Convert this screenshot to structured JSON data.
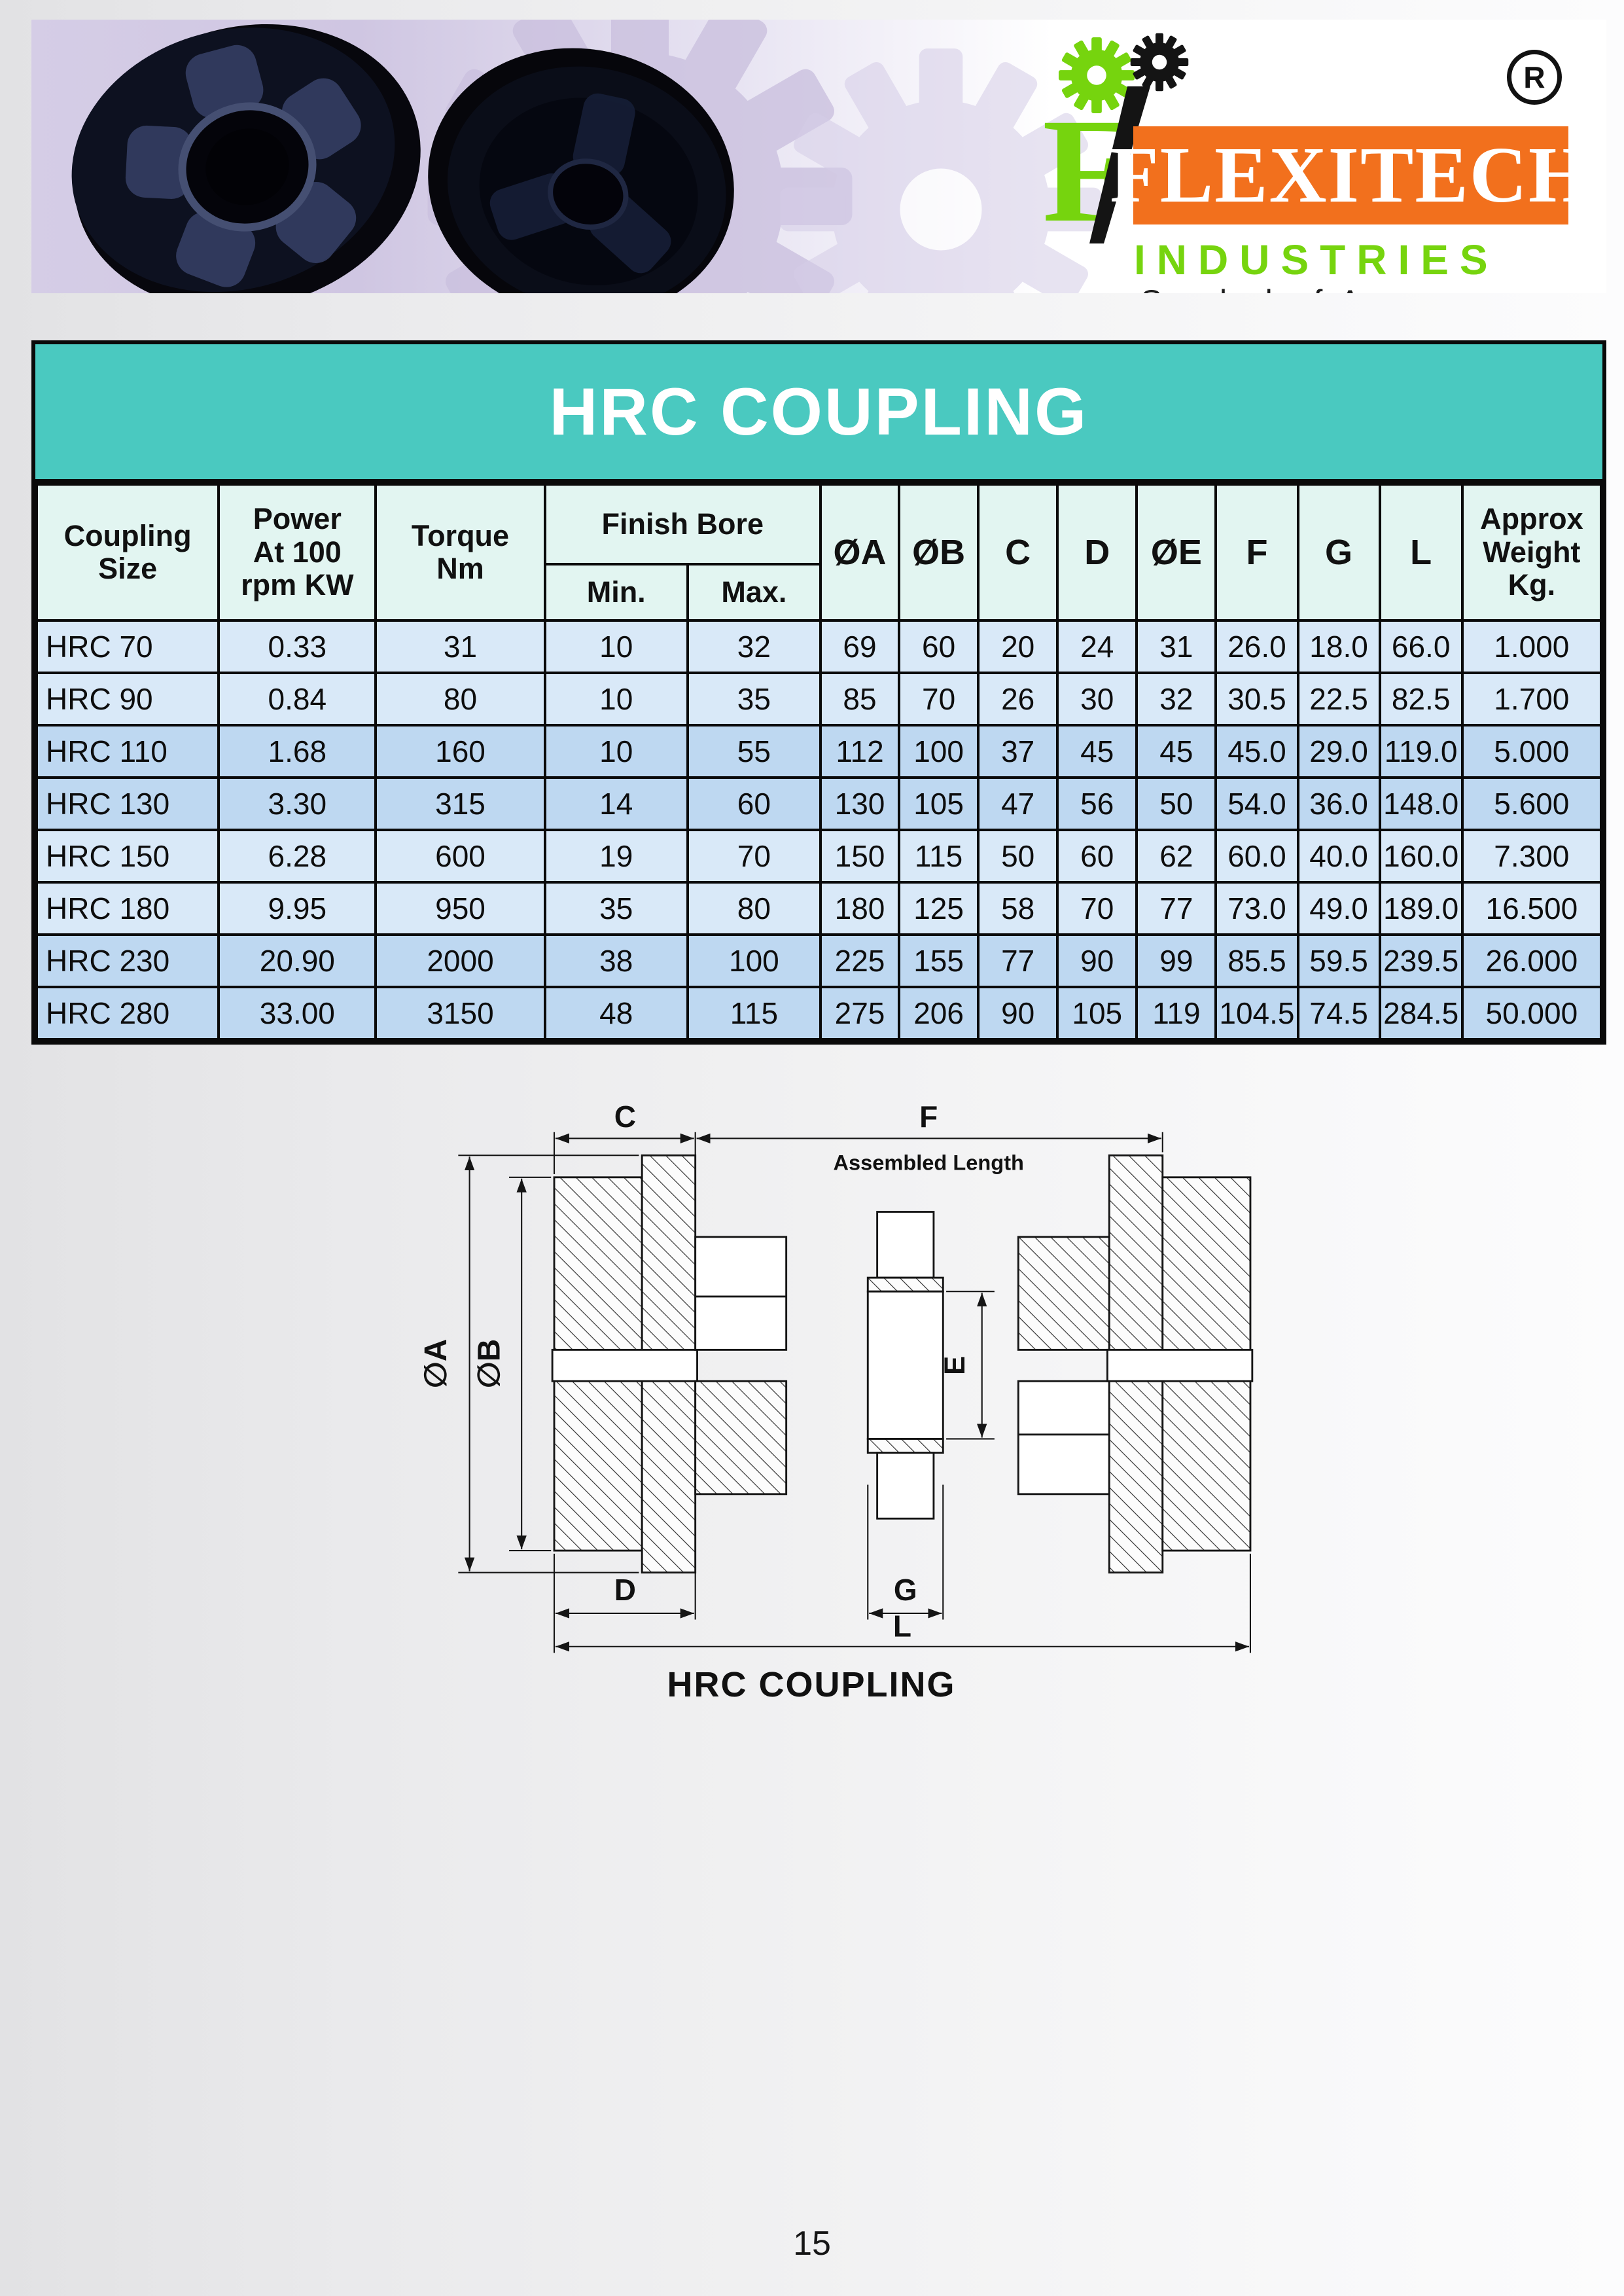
{
  "brand": {
    "name": "FLEXITECH",
    "division": "INDUSTRIES",
    "tagline": "Symbol of Accuracy",
    "registered": "R",
    "colors": {
      "orange": "#f2701d",
      "green": "#76d40e",
      "teal": "#4ac9c0"
    }
  },
  "title_banner": {
    "text": "HRC COUPLING"
  },
  "table": {
    "header": {
      "coupling_size": "Coupling\nSize",
      "power": "Power\nAt 100\nrpm KW",
      "torque": "Torque\nNm",
      "finish_bore": "Finish Bore",
      "min": "Min.",
      "max": "Max.",
      "dia_a": "ØA",
      "dia_b": "ØB",
      "c": "C",
      "d": "D",
      "dia_e": "ØE",
      "f": "F",
      "g": "G",
      "l": "L",
      "weight": "Approx\nWeight\nKg."
    },
    "rows": [
      [
        "HRC 70",
        "0.33",
        "31",
        "10",
        "32",
        "69",
        "60",
        "20",
        "24",
        "31",
        "26.0",
        "18.0",
        "66.0",
        "1.000"
      ],
      [
        "HRC 90",
        "0.84",
        "80",
        "10",
        "35",
        "85",
        "70",
        "26",
        "30",
        "32",
        "30.5",
        "22.5",
        "82.5",
        "1.700"
      ],
      [
        "HRC 110",
        "1.68",
        "160",
        "10",
        "55",
        "112",
        "100",
        "37",
        "45",
        "45",
        "45.0",
        "29.0",
        "119.0",
        "5.000"
      ],
      [
        "HRC 130",
        "3.30",
        "315",
        "14",
        "60",
        "130",
        "105",
        "47",
        "56",
        "50",
        "54.0",
        "36.0",
        "148.0",
        "5.600"
      ],
      [
        "HRC 150",
        "6.28",
        "600",
        "19",
        "70",
        "150",
        "115",
        "50",
        "60",
        "62",
        "60.0",
        "40.0",
        "160.0",
        "7.300"
      ],
      [
        "HRC 180",
        "9.95",
        "950",
        "35",
        "80",
        "180",
        "125",
        "58",
        "70",
        "77",
        "73.0",
        "49.0",
        "189.0",
        "16.500"
      ],
      [
        "HRC 230",
        "20.90",
        "2000",
        "38",
        "100",
        "225",
        "155",
        "77",
        "90",
        "99",
        "85.5",
        "59.5",
        "239.5",
        "26.000"
      ],
      [
        "HRC 280",
        "33.00",
        "3150",
        "48",
        "115",
        "275",
        "206",
        "90",
        "105",
        "119",
        "104.5",
        "74.5",
        "284.5",
        "50.000"
      ]
    ]
  },
  "drawing": {
    "labels": {
      "c": "C",
      "f": "F",
      "assembled_length": "Assembled Length",
      "dia_a": "∅A",
      "dia_b": "∅B",
      "e": "E",
      "d": "D",
      "g": "G",
      "l": "L"
    },
    "caption": "HRC COUPLING"
  },
  "page": {
    "number": "15"
  }
}
